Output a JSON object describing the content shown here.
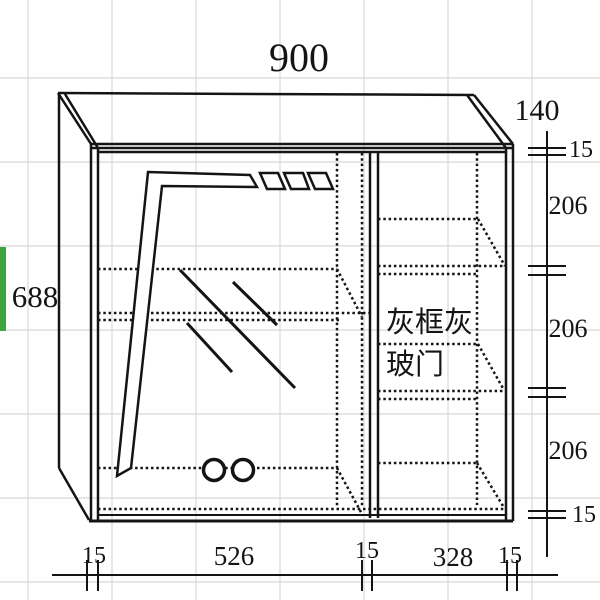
{
  "canvas": {
    "width": 600,
    "height": 600,
    "description": "CAD-style oblique drawing of a wall cabinet with grey-framed grey glass door, on a spreadsheet-like grid background"
  },
  "dimension_labels": {
    "top_width": "900",
    "top_depth": "140",
    "left_height": "688",
    "right_column": [
      "15",
      "206",
      "206",
      "206",
      "15"
    ],
    "bottom_row": [
      "15",
      "526",
      "15",
      "328",
      "15"
    ]
  },
  "annotations": {
    "door_label_line1": "灰框灰",
    "door_label_line2": "玻门"
  },
  "colors": {
    "line": "#141414",
    "grid": "#d8d8d8",
    "green_bar": "#3fa33f",
    "background": "#ffffff"
  }
}
